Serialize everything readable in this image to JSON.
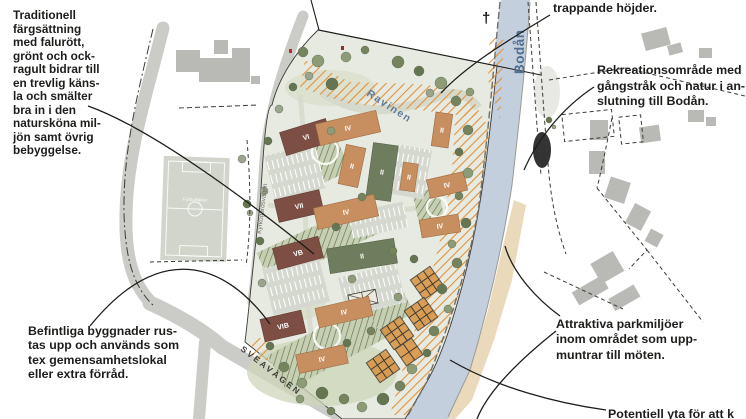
{
  "annotations": {
    "traditionell": "Traditionell\nfärgsättning\nmed falurött,\ngrönt och ock-\nragult bidrar till\nen trevlig käns-\nla och smälter\nbra in i den\nnatursköna mil-\njön samt övrig\nbebyggelse.",
    "trappande": "trappande höjder.",
    "rekreation": "Rekreationsområde med\ngångstråk och natur i an-\nslutning till Bodån.",
    "befintliga": "Befintliga byggnader rus-\ntas upp och används som\ntex gemensamhetslokal\neller extra förråd.",
    "attraktiva": "Attraktiva parkmiljöer\ninom området som upp-\nmuntrar till möten.",
    "potentiell": "Potentiell yta för att k"
  },
  "map_labels": {
    "river": "Bodån",
    "ravine": "Ravinen",
    "road_south": "SVEAVÄGEN",
    "road_west": "Kyrkogårdsvägen",
    "football_field": "Fotbollsplan",
    "church_symbol": "†"
  },
  "buildings": [
    {
      "label": "VI"
    },
    {
      "label": "IV"
    },
    {
      "label": "II"
    },
    {
      "label": "II"
    },
    {
      "label": "II"
    },
    {
      "label": "II"
    },
    {
      "label": "VII"
    },
    {
      "label": "IV"
    },
    {
      "label": "VB"
    },
    {
      "label": "II"
    },
    {
      "label": "IV"
    },
    {
      "label": "IV"
    },
    {
      "label": "IV"
    },
    {
      "label": "VIB"
    },
    {
      "label": "IV"
    }
  ],
  "colors": {
    "building_red": "#7d4e44",
    "building_tan": "#c78e60",
    "building_green": "#6d7d5d",
    "river": "#c4cfde",
    "orange_hatch": "#e0923f",
    "green_hatch": "#5e7150",
    "road": "#cbccc7",
    "label_blue": "#4e6f90",
    "plan_bg": "#e7eae0"
  }
}
